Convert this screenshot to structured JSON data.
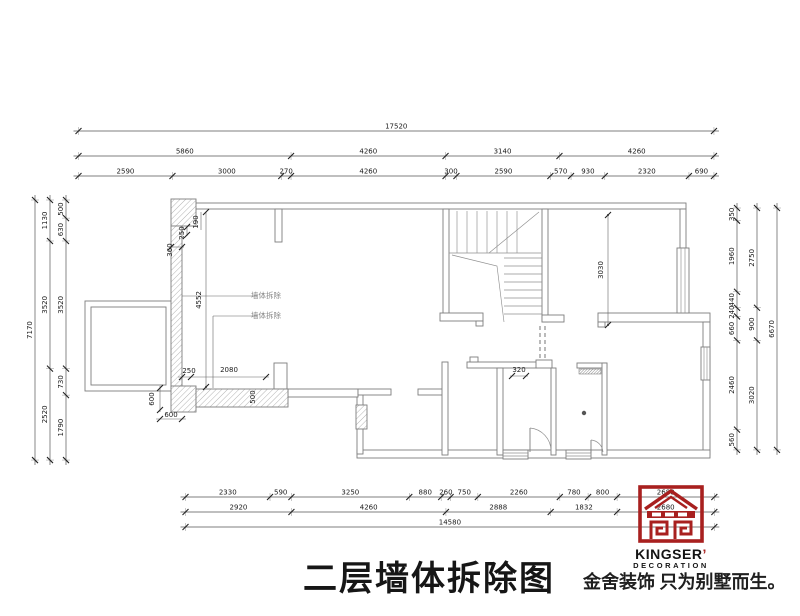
{
  "title": {
    "text": "二层墙体拆除图"
  },
  "brand": {
    "name": "KINGSER",
    "apostrophe": "’",
    "subtitle": "DECORATION",
    "slogan": "金舍装饰 只为别墅而生。",
    "logo_color": "#a8201f"
  },
  "colors": {
    "wall_line": "#7e7e7e",
    "dim_text": "#1a1a1a",
    "note_text": "#8a8a8a",
    "brand_red": "#a8201f"
  },
  "dimensions": {
    "scale_px_per_mm": 0.03627,
    "chains": [
      {
        "name": "top-total",
        "orient": "h",
        "pos": 131,
        "origin": 78.5,
        "values": [
          17520
        ]
      },
      {
        "name": "top-mid",
        "orient": "h",
        "pos": 156,
        "origin": 78.5,
        "values": [
          5860,
          4260,
          3140,
          4260
        ]
      },
      {
        "name": "top-detail",
        "orient": "h",
        "pos": 176,
        "origin": 78.5,
        "values": [
          2590,
          3000,
          270,
          4260,
          300,
          2590,
          570,
          930,
          2320,
          690
        ]
      },
      {
        "name": "left-total",
        "orient": "v",
        "pos": 35,
        "origin": 200,
        "values": [
          7170
        ]
      },
      {
        "name": "left-mid",
        "orient": "v",
        "pos": 50,
        "origin": 200,
        "values": [
          1130,
          3520,
          2520
        ]
      },
      {
        "name": "left-detail",
        "orient": "v",
        "pos": 66,
        "origin": 200,
        "values": [
          500,
          630,
          3520,
          730,
          1790
        ]
      },
      {
        "name": "right-detail",
        "orient": "v",
        "pos": 737,
        "origin": 208,
        "values": [
          350,
          1960,
          440,
          240,
          660,
          2460,
          560
        ]
      },
      {
        "name": "right-mid",
        "orient": "v",
        "pos": 757,
        "origin": 208,
        "values": [
          2750,
          900,
          3020
        ]
      },
      {
        "name": "right-total",
        "orient": "v",
        "pos": 777,
        "origin": 208,
        "values": [
          6670
        ]
      },
      {
        "name": "bottom-detail",
        "orient": "h",
        "pos": 497,
        "origin": 185.5,
        "values": [
          2330,
          590,
          3250,
          880,
          260,
          750,
          2260,
          780,
          800,
          2680
        ]
      },
      {
        "name": "bottom-mid",
        "orient": "h",
        "pos": 512,
        "origin": 185.5,
        "values": [
          2920,
          4260,
          2888,
          1832,
          2680
        ]
      },
      {
        "name": "bottom-total",
        "orient": "h",
        "pos": 527,
        "origin": 185.5,
        "values": [
          14580
        ]
      }
    ],
    "interior": [
      {
        "text": "4552",
        "x": 201,
        "y": 300,
        "rot": -90
      },
      {
        "text": "190",
        "x": 198,
        "y": 222,
        "rot": -90
      },
      {
        "text": "250",
        "x": 184,
        "y": 233,
        "rot": -90
      },
      {
        "text": "360",
        "x": 172,
        "y": 250,
        "rot": -90
      },
      {
        "text": "250",
        "x": 189,
        "y": 373
      },
      {
        "text": "2080",
        "x": 229,
        "y": 372
      },
      {
        "text": "600",
        "x": 154,
        "y": 399,
        "rot": -90
      },
      {
        "text": "600",
        "x": 171,
        "y": 417
      },
      {
        "text": "500",
        "x": 255,
        "y": 397,
        "rot": -90
      },
      {
        "text": "320",
        "x": 519,
        "y": 372
      },
      {
        "text": "3030",
        "x": 603,
        "y": 270,
        "rot": -90
      },
      {
        "text": "墙体拆除",
        "x": 266,
        "y": 298,
        "cn": true
      },
      {
        "text": "墙体拆除",
        "x": 266,
        "y": 318,
        "cn": true
      }
    ]
  }
}
